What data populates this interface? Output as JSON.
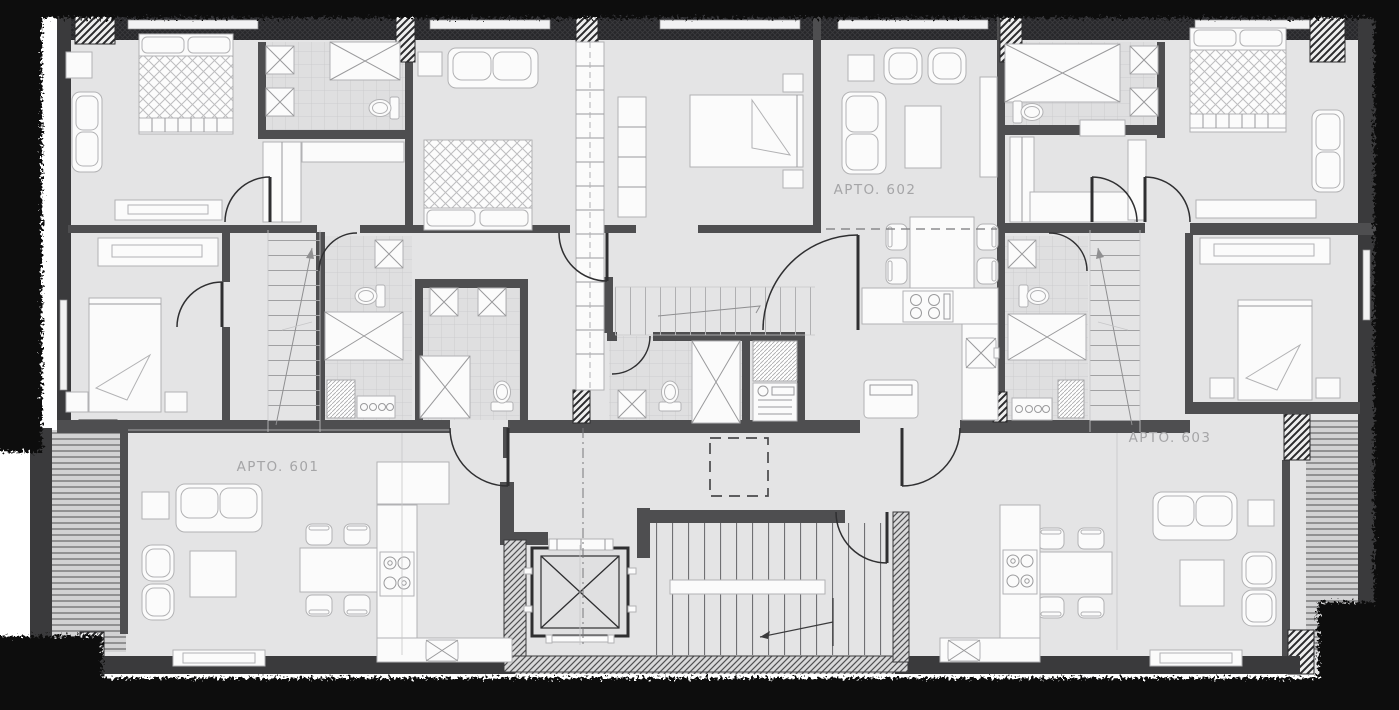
{
  "title": "apartment-floor-plan",
  "apartments": [
    {
      "label": "APTO. 601"
    },
    {
      "label": "APTO. 602"
    },
    {
      "label": "APTO. 603"
    }
  ],
  "symbols": [
    "elevator-icon",
    "stair-icon",
    "toilet-icon",
    "shower-icon",
    "sink-icon",
    "stove-icon",
    "bed-icon",
    "sofa-icon",
    "dining-table-icon",
    "washer-icon",
    "column-hatch-icon",
    "deck-boards-icon",
    "void-dashed-icon",
    "door-swing-icon"
  ],
  "colors": {
    "paper": "#ffffff",
    "floor": "#e4e4e5",
    "floorTile": "#dfdfe0",
    "wall": "#4e4e50",
    "wallDark": "#3a3a3c",
    "wallBand": "#28282b",
    "furn": "#fbfbfb",
    "furnStroke": "#b2b2b4",
    "line": "#8f8f91",
    "door": "#2f2f31",
    "label": "#a5a5a7",
    "border": "#0b0b0b",
    "deck": "#d2d2d3"
  }
}
